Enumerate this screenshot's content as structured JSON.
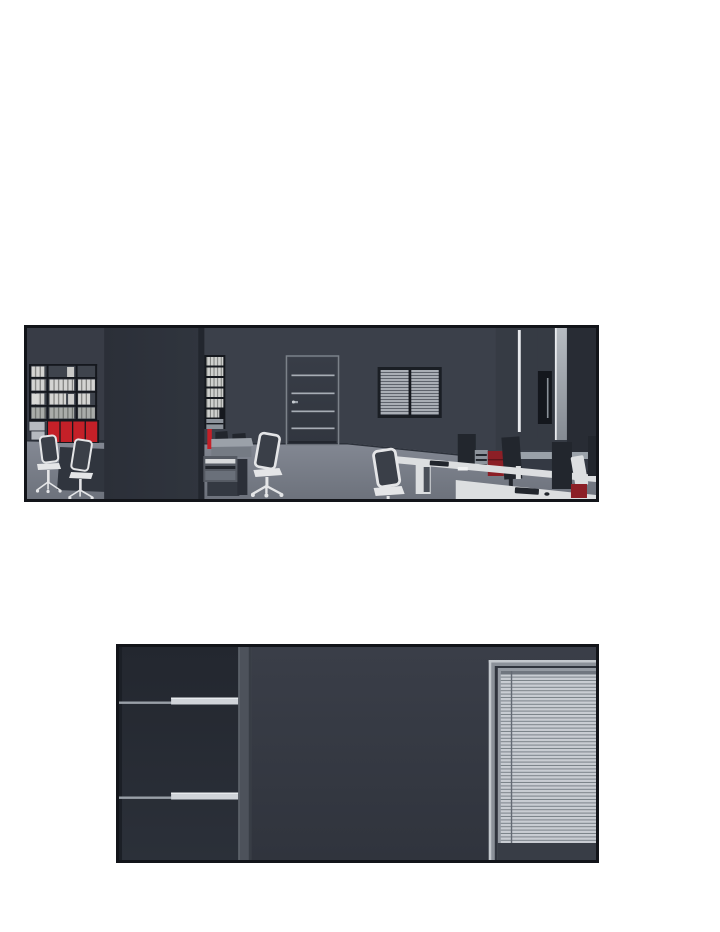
{
  "page": {
    "type": "webtoon-comic-page",
    "background_note": "white page with two wide borderless-gutter comic panels, no text or balloons"
  },
  "panels": [
    {
      "name": "office-panel",
      "description": "Wide panel: empty dark office at night. Left wall has shelves full of white binders over bright red cabinet doors, two office chairs in front. A dark pillar divides the room; beside it a tall file column, a red extinguisher strip, a copier and a desk with monitor backs. Center wall has a paneled door with thin metal strips and a blind-covered window. Right side shows tall cabinets, a row of white desks with dark monitors, privacy screens, a dark-red pedestal cabinet and white mesh office chairs."
    },
    {
      "name": "dark-room-panel",
      "description": "Panel: dim room corner. A dark navy shelving unit with two long light shelf edges fills the left side, separated by a gray support column from a wall that holds a large window fully covered by closed venetian blinds."
    }
  ],
  "colors": {
    "paper": "#ffffff",
    "panel-border": "#121419",
    "wall": "#3b404a",
    "wall-left": "#383c46",
    "cab-zone": "#31363f",
    "baseboard": "#2c313a",
    "pillar-edge": "#22262e",
    "floor-top": "#848994",
    "floor-bottom": "#6d727c",
    "shelf-frame": "#15181e",
    "shelf-back": "#3f444d",
    "binder-light": "#d4d4d2",
    "binder-line": "#7e7e7c",
    "binder-dim": "#a9aca9",
    "binder-dim-line": "#6f726f",
    "box-light": "#b6bac0",
    "red": "#c42028",
    "red-dark": "#8c1f26",
    "chair-white": "#e4e5e7",
    "chair-dark": "#3a3f48",
    "dark-cab": "#30353e",
    "desk": "#dcdee0",
    "desk-gray": "#9ba1a9",
    "desk-front": "#757b84",
    "copier": "#565b64",
    "tray": "#d7d9db",
    "monitor": "#22262d",
    "door-top": "#383d47",
    "door-bottom": "#31363f",
    "door-line": "#a7adb5",
    "window-frame": "#1a1e24",
    "slat-sm-light": "#a9aeb5",
    "slat-sm-dark": "#555b64",
    "bright-line": "#e8eaed",
    "panel-mid": "#363b44",
    "slot": "#14171d",
    "strip-top": "#b7bcc2",
    "strip-bottom": "#858b93",
    "right-dark": "#282c34",
    "credenza": "#9aa1a9",
    "under-credenza": "#343943",
    "drawer-light": "#8d939b",
    "navy-top": "#23272f",
    "navy-bottom": "#2b3039",
    "navy-edge": "#1b1f26",
    "divider": "#4d525b",
    "divider-lite": "#5d626b",
    "divider-dark": "#383d45",
    "bg2-top": "#3a3e48",
    "bg2-bottom": "#30343d",
    "shelf-line": "#99a0a8",
    "shelf-bar": "#d0d4d9",
    "shelf-bar-hi": "#e8ebee",
    "frame-light": "#949aa2",
    "frame-bright": "#c3c8cd",
    "frame-gap": "#2f343d",
    "blind-light": "#c9cdd3",
    "blind-dark": "#7b8289",
    "headrail": "#70767f",
    "ladder": "#646a74",
    "sill": "#383d46"
  }
}
